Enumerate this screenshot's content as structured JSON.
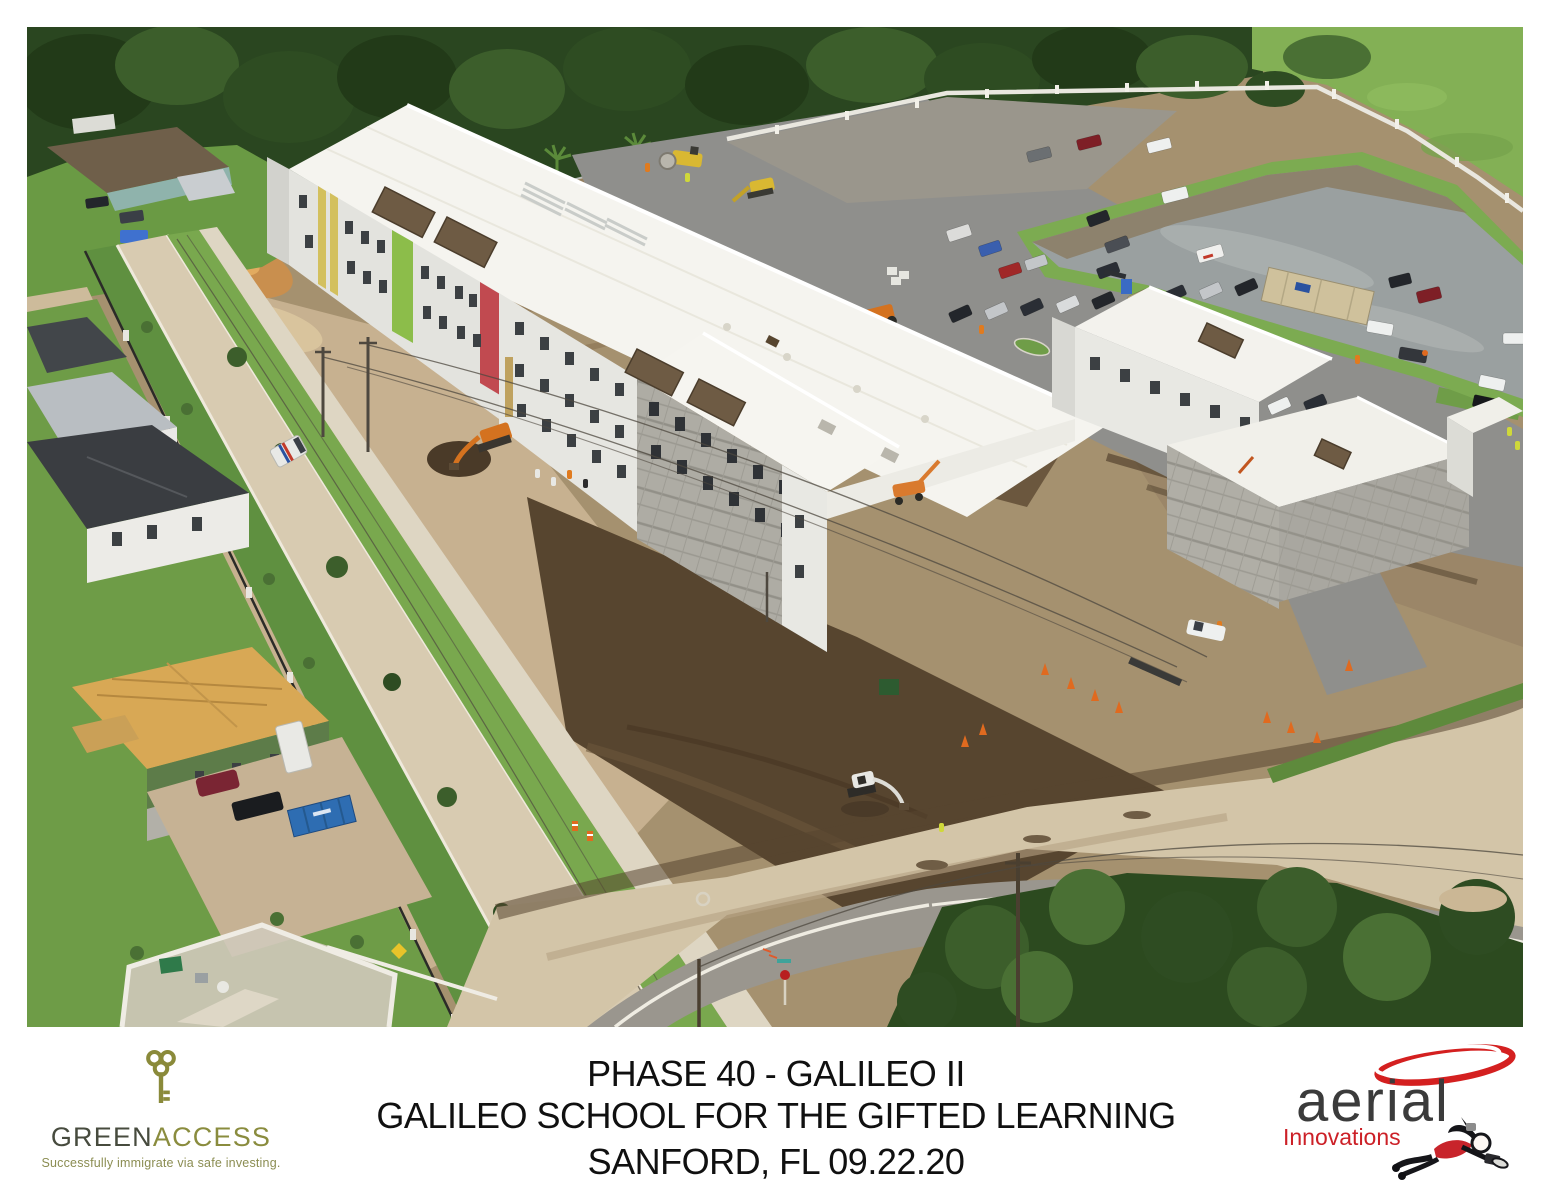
{
  "footer": {
    "caption": {
      "line1": "PHASE 40 - GALILEO II",
      "line2": "GALILEO SCHOOL FOR THE GIFTED LEARNING",
      "line3": "SANFORD, FL 09.22.20"
    },
    "greenaccess": {
      "brand_part1": "GREEN",
      "brand_part2": "ACCESS",
      "tagline": "Successfully immigrate via safe investing.",
      "colors": {
        "part1": "#474b3e",
        "part2": "#8a8c3e",
        "key": "#8a8a3a"
      }
    },
    "aerial_innovations": {
      "name": "aerial",
      "subtitle": "Innovations",
      "colors": {
        "name": "#3b3b3b",
        "subtitle": "#cc2027",
        "swoosh": "#d42020"
      }
    }
  },
  "photo": {
    "palette": {
      "treeline": "#2a4620",
      "grass": "#6e9c47",
      "pasture": "#83b055",
      "dirt": "#a5916f",
      "mud": "#57452f",
      "sand": "#c7b190",
      "building_white": "#f5f4ef",
      "accent_yellow": "#d3c05e",
      "accent_green": "#8cbd4a",
      "accent_red": "#c14a50",
      "pond_water": "#9aa0a0",
      "asphalt": "#8f8f8c",
      "road_dirt": "#d8cbb1"
    }
  }
}
